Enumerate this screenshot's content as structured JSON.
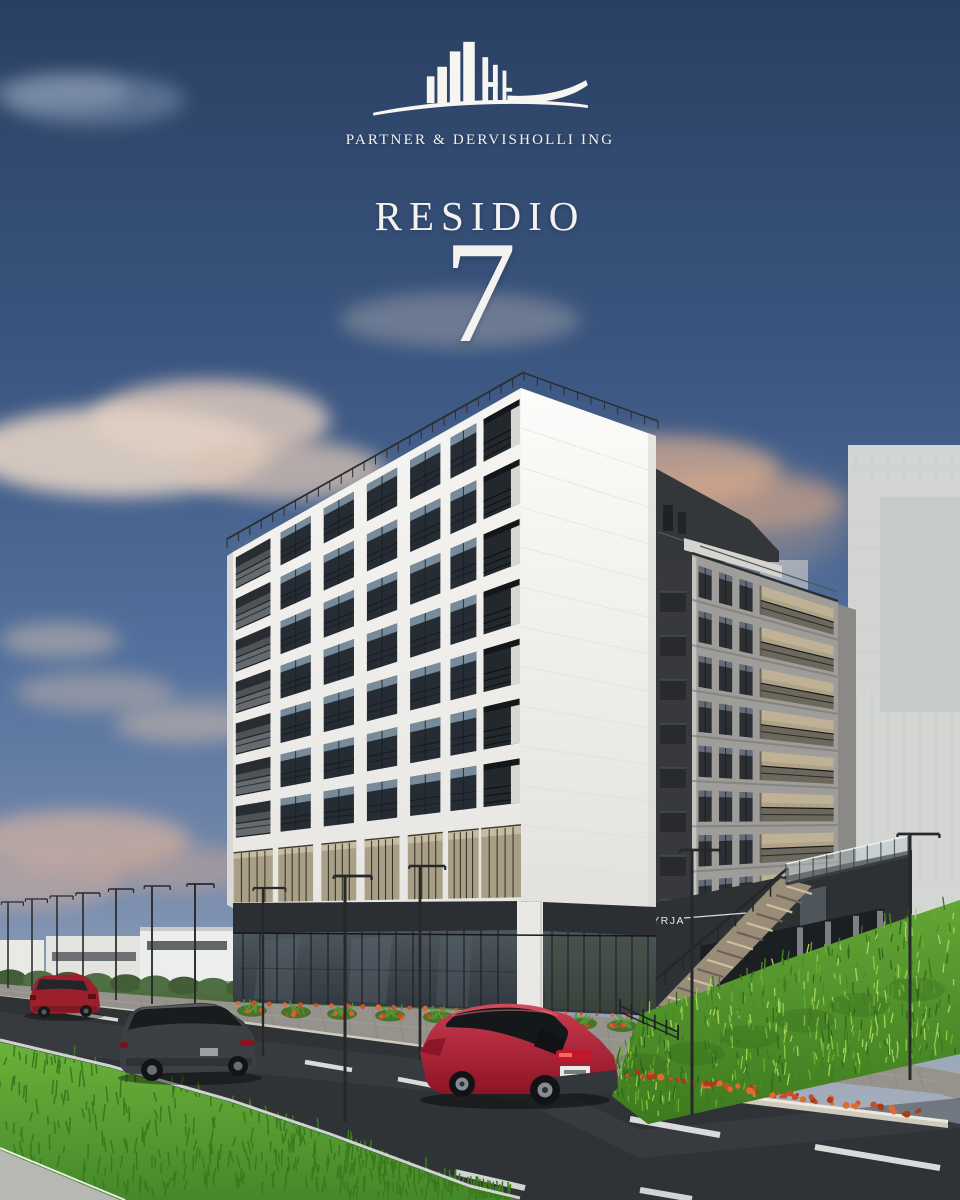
{
  "brand": {
    "company_name": "PARTNER & DERVISHOLLI ING",
    "logo_icon": "building-skyline-icon"
  },
  "project": {
    "title": "RESIDIO",
    "number": "7"
  },
  "scene": {
    "entrance_sign": "HYRJA"
  },
  "palette": {
    "sky_top": "#2a4062",
    "sky_mid": "#54719d",
    "sky_horizon": "#b5b7bb",
    "cloud_pink": "#e0c9bb",
    "sun_glow": "#d9ad92",
    "facade_white": "#f2f1ee",
    "facade_gray": "#a09f9b",
    "facade_dark": "#3a3d40",
    "storefront_dark": "#2b2e32",
    "glass_blue": "#4a525a",
    "mezzanine_tan": "#a99e86",
    "grass_green": "#5d9c33",
    "road_asphalt": "#303336",
    "lane_marking": "#e3e5e4",
    "flower_orange": "#d85f2b",
    "car_red": "#a6192e",
    "car_dark_gray": "#3c4045",
    "text_white": "#f4f2ee"
  }
}
